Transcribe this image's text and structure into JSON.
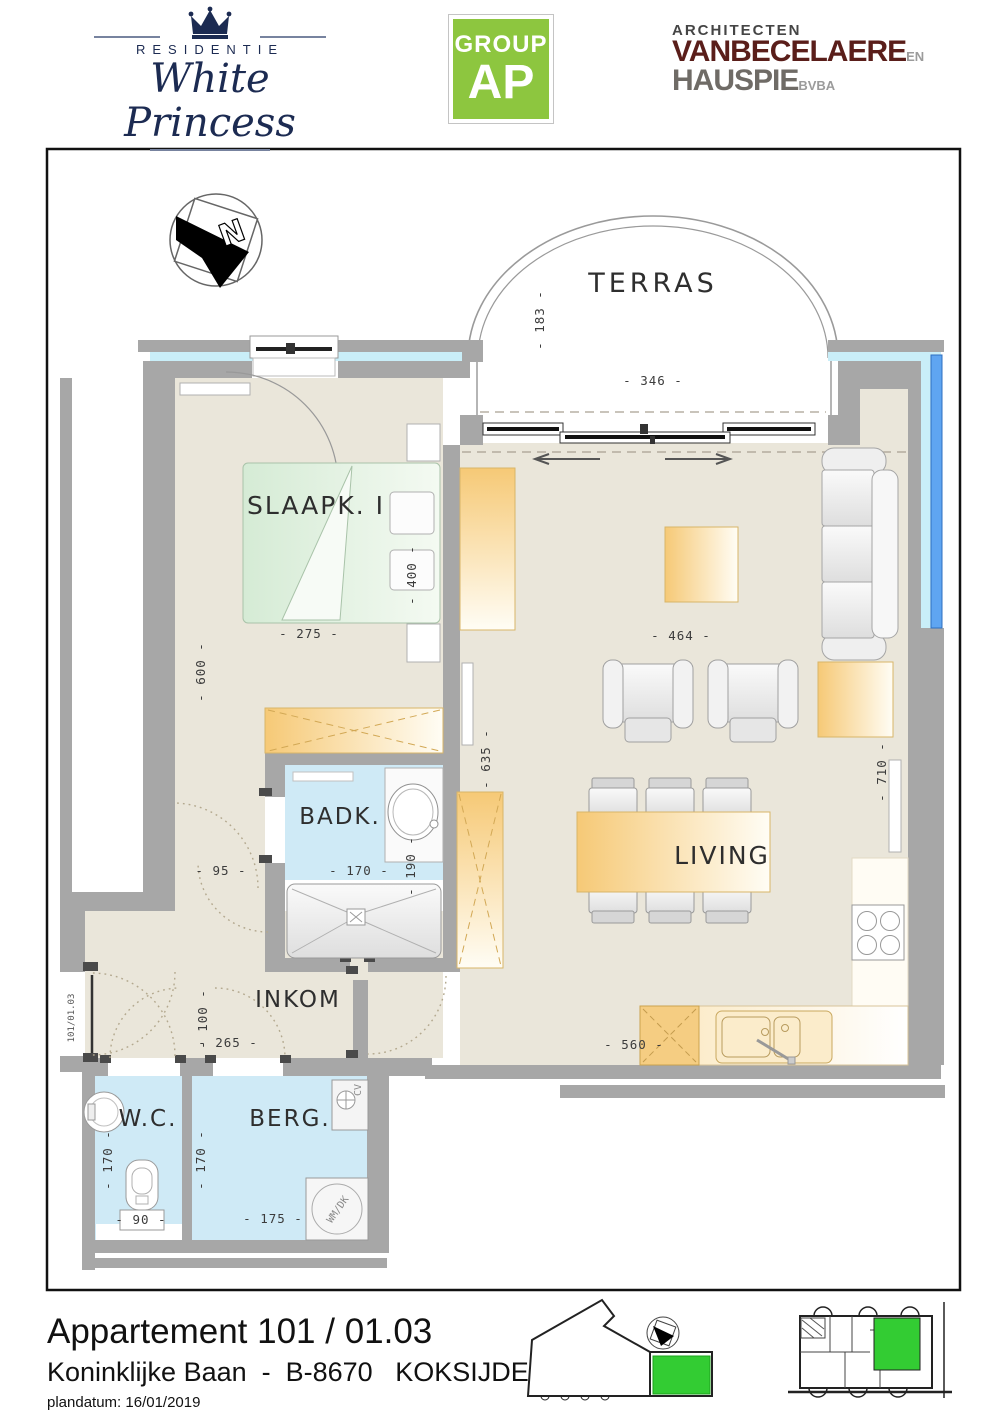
{
  "header": {
    "residentie_label": "RESIDENTIE",
    "brand_name": "White Princess",
    "group_label": "GROUP",
    "group_ap": "AP",
    "architects_top": "ARCHITECTEN",
    "architects_name1": "VANBECELAERE",
    "architects_en": "EN",
    "architects_name2": "HAUSPIE",
    "architects_suffix": "BVBA"
  },
  "plan": {
    "compass_letter": "N",
    "rooms": {
      "terras": "TERRAS",
      "slaapkamer": "SLAAPK. I",
      "badkamer": "BADK.",
      "inkom": "INKOM",
      "wc": "W.C.",
      "berging": "BERG.",
      "living": "LIVING"
    },
    "dims": {
      "terras_depth": "- 183 -",
      "terras_width": "- 346 -",
      "slaapk_width": "- 275 -",
      "bed_width": "- 400 -",
      "slaapk_depth": "- 600 -",
      "hal_width": "- 95 -",
      "badk_width": "- 170 -",
      "badk_depth": "- 190 -",
      "kast_depth": "- 635 -",
      "living_width": "- 464 -",
      "living_depth": "- 710 -",
      "inkom_depth": "- 100 -",
      "inkom_width": "- 265 -",
      "keuken_width": "- 560 -",
      "wc_depth": "- 170 -",
      "wc_width": "- 90 -",
      "berg_depth": "- 170 -",
      "berg_width": "- 175 -"
    },
    "door_label": "101/01.03",
    "appliances": {
      "washer": "WM/DK",
      "boiler": "CV"
    }
  },
  "footer": {
    "title": "Appartement 101 / 01.03",
    "address": "Koninklijke Baan  -  B-8670   KOKSIJDE",
    "plan_date": "plandatum: 16/01/2019"
  },
  "colors": {
    "brand_navy": "#1c2b52",
    "group_green": "#8dc63f",
    "architect_maroon": "#5a1e1a",
    "architect_gray": "#6f6b66",
    "highlight_green": "#33cc33",
    "wall_gray": "#a7a7a7",
    "floor_beige": "#eae6da",
    "wet_room_blue": "#cfeaf6",
    "furniture_orange": "#f6c976",
    "glazing_cyan": "#c9eef8",
    "window_blue": "#5fa5f1"
  }
}
